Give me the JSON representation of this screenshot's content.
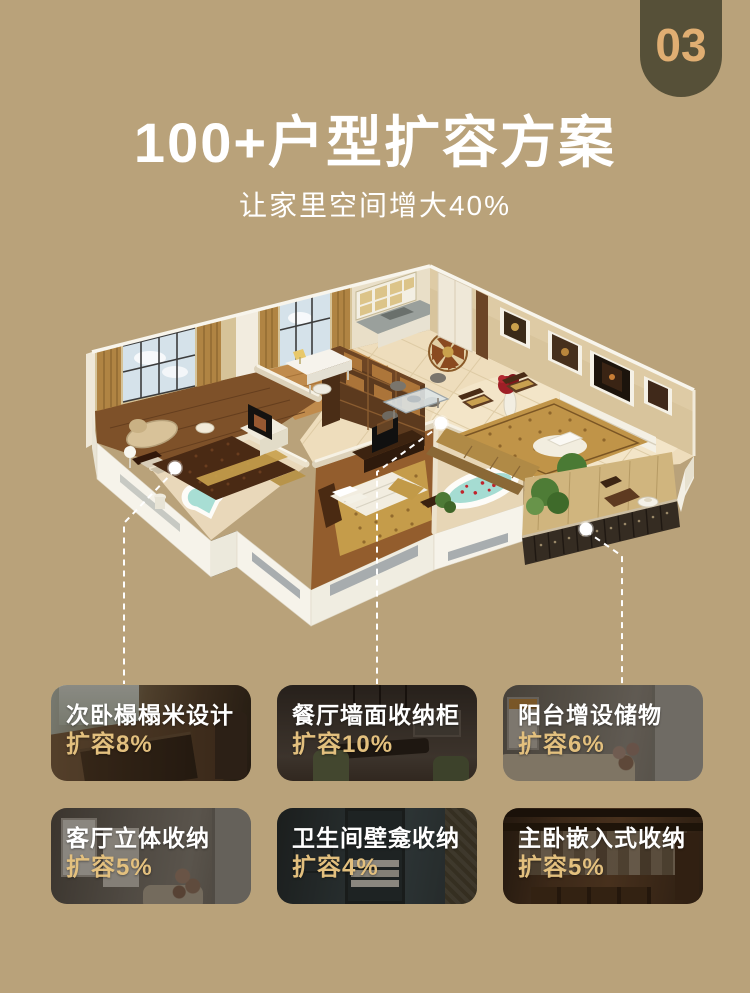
{
  "page": {
    "badge_number": "03",
    "title": "100+户型扩容方案",
    "subtitle": "让家里空间增大40%"
  },
  "colors": {
    "background": "#b9a27a",
    "badge_bg": "#565038",
    "badge_text": "#e0ae72",
    "title_text": "#ffffff",
    "card_title_text": "#ffffff",
    "card_value_text": "#e3c07e",
    "leader_line": "#ffffff"
  },
  "floor_plan": {
    "description": "isometric-3d-apartment-render",
    "markers": 3
  },
  "cards": [
    {
      "title": "次卧榻榻米设计",
      "highlight": "扩容8%",
      "photo": "tatami-room"
    },
    {
      "title": "餐厅墙面收纳柜",
      "highlight": "扩容10%",
      "photo": "dining-room"
    },
    {
      "title": "阳台增设储物",
      "highlight": "扩容6%",
      "photo": "balcony-storage"
    },
    {
      "title": "客厅立体收纳",
      "highlight": "扩容5%",
      "photo": "living-room-storage"
    },
    {
      "title": "卫生间壁龛收纳",
      "highlight": "扩容4%",
      "photo": "bathroom-niche"
    },
    {
      "title": "主卧嵌入式收纳",
      "highlight": "扩容5%",
      "photo": "walk-in-closet"
    }
  ]
}
